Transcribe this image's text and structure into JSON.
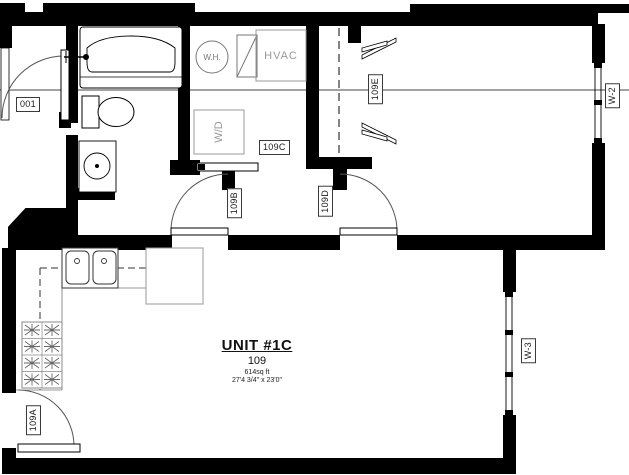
{
  "floor_plan": {
    "title": {
      "unit_name": "UNIT #1C",
      "unit_number": "109",
      "area": "614sq ft",
      "dimensions": "27'4 3/4\" x 23'0\""
    },
    "door_labels": {
      "d001": "001",
      "d109a": "109A",
      "d109b": "109B",
      "d109d": "109D"
    },
    "room_labels": {
      "laundry": "109C",
      "closet": "109E"
    },
    "window_labels": {
      "w2": "W-2",
      "w3": "W-3"
    },
    "fixture_labels": {
      "water_heater": "W.H.",
      "hvac": "HVAC",
      "washer_dryer": "W/D"
    },
    "colors": {
      "wall": "#000000",
      "equipment_gray": "#999999",
      "line_gray": "#666666"
    }
  }
}
